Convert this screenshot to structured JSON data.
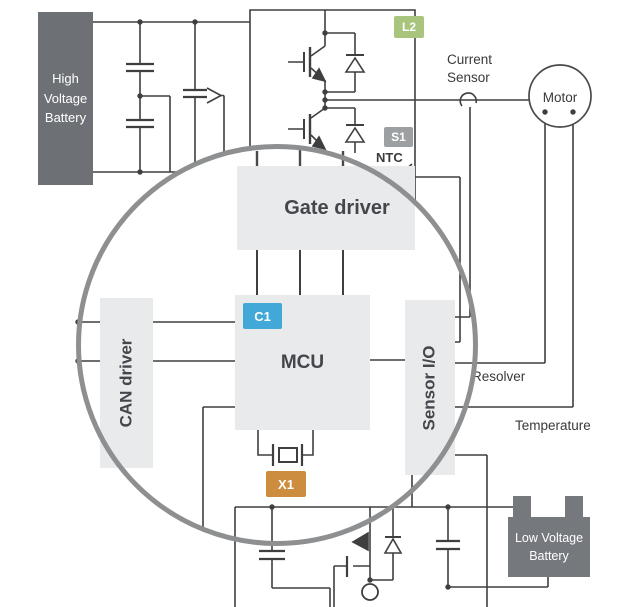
{
  "diagram": {
    "blocks": {
      "hv_battery": {
        "label": "High Voltage Battery"
      },
      "gate_driver": {
        "label": "Gate driver"
      },
      "mcu": {
        "label": "MCU"
      },
      "can_driver": {
        "label": "CAN driver"
      },
      "sensor_io": {
        "label": "Sensor I/O"
      },
      "motor": {
        "label": "Motor"
      },
      "lv_battery": {
        "label": "Low Voltage Battery"
      }
    },
    "badges": {
      "l2": {
        "label": "L2",
        "color": "#a9c47c"
      },
      "s1": {
        "label": "S1",
        "color": "#9da0a3"
      },
      "c1": {
        "label": "C1",
        "color": "#41a8d7"
      },
      "x1": {
        "label": "X1",
        "color": "#cd8d3e"
      }
    },
    "annotations": {
      "current_sensor": "Current Sensor",
      "ntc": "NTC",
      "resolver": "Resolver",
      "temperature": "Temperature"
    },
    "colors": {
      "wire": "#3f3f3f",
      "block_fill": "#e9eaec",
      "block_text": "#43474c",
      "hv_battery_fill": "#6d7176",
      "lv_battery_fill": "#75797d",
      "magnifier_ring": "#8d8f91"
    }
  }
}
